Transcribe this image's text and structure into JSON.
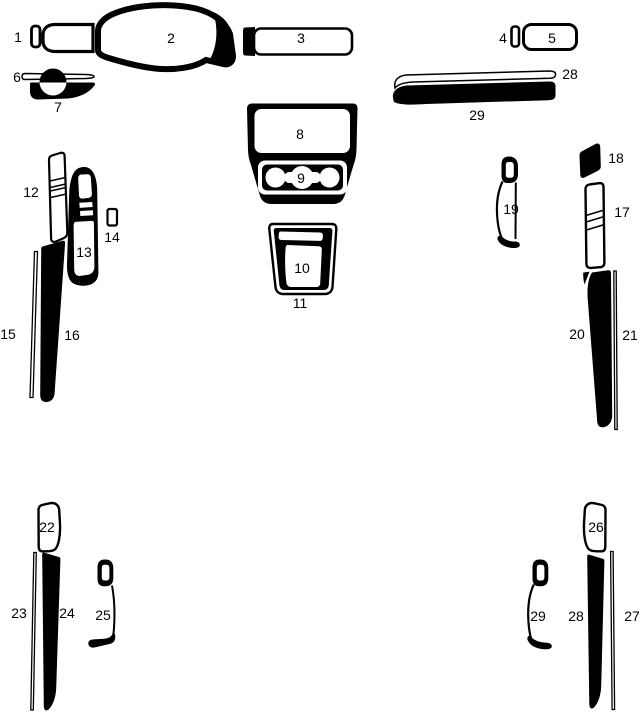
{
  "colors": {
    "ink": "#000000",
    "paper": "#ffffff"
  },
  "labels": [
    {
      "text": "1"
    },
    {
      "text": "2"
    },
    {
      "text": "3"
    },
    {
      "text": "4"
    },
    {
      "text": "5"
    },
    {
      "text": "6"
    },
    {
      "text": "7"
    },
    {
      "text": "8"
    },
    {
      "text": "9"
    },
    {
      "text": "10"
    },
    {
      "text": "11"
    },
    {
      "text": "12"
    },
    {
      "text": "13"
    },
    {
      "text": "14"
    },
    {
      "text": "15"
    },
    {
      "text": "16"
    },
    {
      "text": "17"
    },
    {
      "text": "18"
    },
    {
      "text": "19"
    },
    {
      "text": "20"
    },
    {
      "text": "21"
    },
    {
      "text": "22"
    },
    {
      "text": "23"
    },
    {
      "text": "24"
    },
    {
      "text": "25"
    },
    {
      "text": "26"
    },
    {
      "text": "27"
    },
    {
      "text": "28"
    },
    {
      "text": "29"
    },
    {
      "text": "28"
    },
    {
      "text": "29"
    }
  ]
}
